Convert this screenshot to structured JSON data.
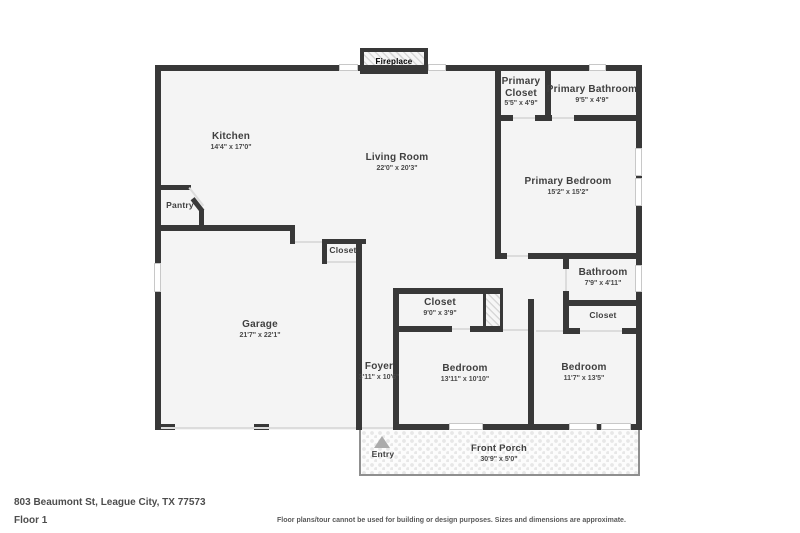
{
  "colors": {
    "wall": "#383838",
    "floor_fill": "#f4f4f4",
    "label_text": "#3f3f3f",
    "porch_border": "#8f8f8f",
    "window_fill": "#ffffff",
    "entry_arrow": "#ababab"
  },
  "rooms": {
    "kitchen": {
      "name": "Kitchen",
      "dims": "14'4\" x 17'0\""
    },
    "living_room": {
      "name": "Living Room",
      "dims": "22'0\" x 20'3\""
    },
    "pantry": {
      "name": "Pantry"
    },
    "primary_closet": {
      "name": "Primary Closet",
      "dims": "5'5\" x 4'9\""
    },
    "primary_bathroom": {
      "name": "Primary Bathroom",
      "dims": "9'5\" x 4'9\""
    },
    "primary_bedroom": {
      "name": "Primary Bedroom",
      "dims": "15'2\" x 15'2\""
    },
    "closet_mid": {
      "name": "Closet"
    },
    "garage": {
      "name": "Garage",
      "dims": "21'7\" x 22'1\""
    },
    "bathroom": {
      "name": "Bathroom",
      "dims": "7'9\" x 4'11\""
    },
    "closet_hall": {
      "name": "Closet",
      "dims": "9'0\" x 3'9\""
    },
    "closet_bedroom2": {
      "name": "Closet"
    },
    "foyer": {
      "name": "Foyer",
      "dims": "3'11\" x 10'6\""
    },
    "bedroom_1": {
      "name": "Bedroom",
      "dims": "13'11\" x 10'10\""
    },
    "bedroom_2": {
      "name": "Bedroom",
      "dims": "11'7\" x 13'5\""
    },
    "front_porch": {
      "name": "Front Porch",
      "dims": "30'9\" x 5'0\""
    }
  },
  "features": {
    "fireplace": "Fireplace",
    "entry": "Entry"
  },
  "footer": {
    "address": "803 Beaumont St, League City, TX 77573",
    "floor": "Floor 1",
    "disclaimer": "Floor plans/tour cannot be used for building or design purposes. Sizes and dimensions are approximate."
  }
}
